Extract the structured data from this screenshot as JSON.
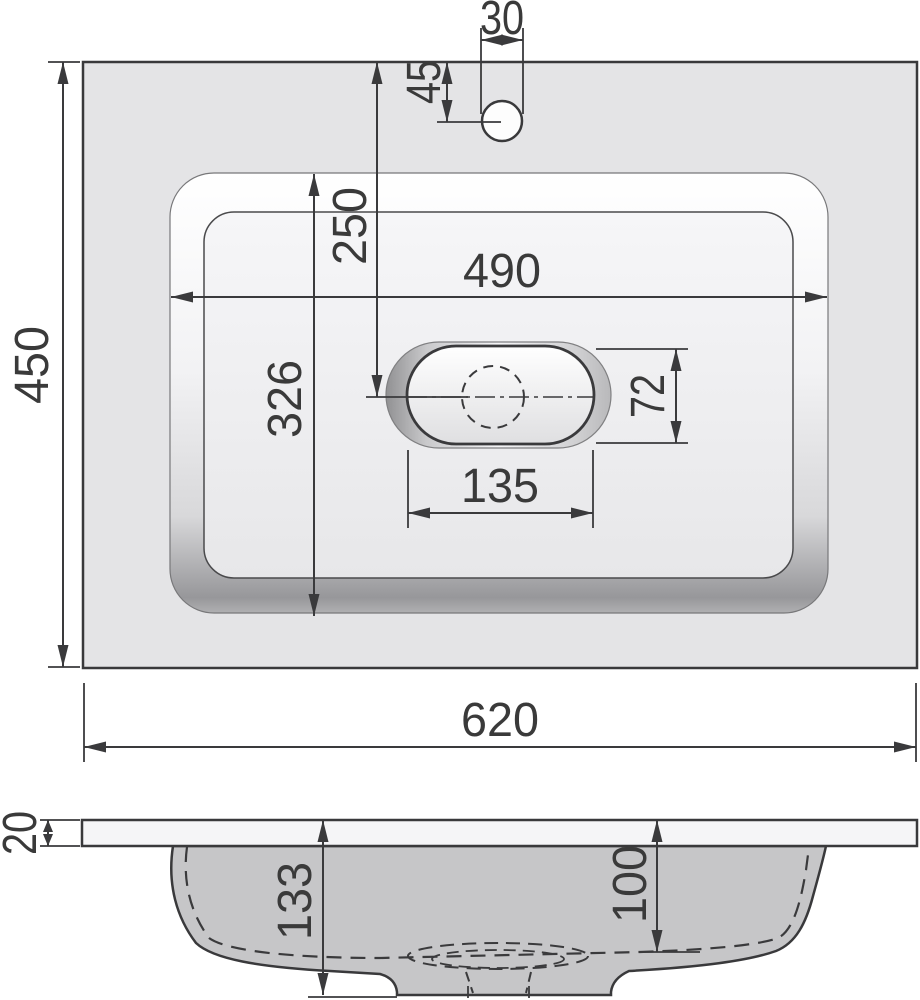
{
  "drawing": {
    "dims": {
      "overall_width": "620",
      "overall_depth": "450",
      "bowl_opening_width": "490",
      "bowl_opening_depth": "326",
      "faucet_hole_diameter": "30",
      "faucet_hole_offset_y": "45",
      "drain_center_offset_y": "250",
      "drain_recess_length": "135",
      "drain_recess_width": "72",
      "countertop_thickness": "20",
      "basin_height": "133",
      "basin_inner_depth": "100"
    },
    "colors": {
      "line": "#3a3a3a",
      "counter_fill": "#e4e4e6",
      "basin_floor_fill": "#f2f2f4",
      "section_body_fill": "#c6c6c8",
      "countertop_slab_fill": "#f5f5f7"
    }
  }
}
